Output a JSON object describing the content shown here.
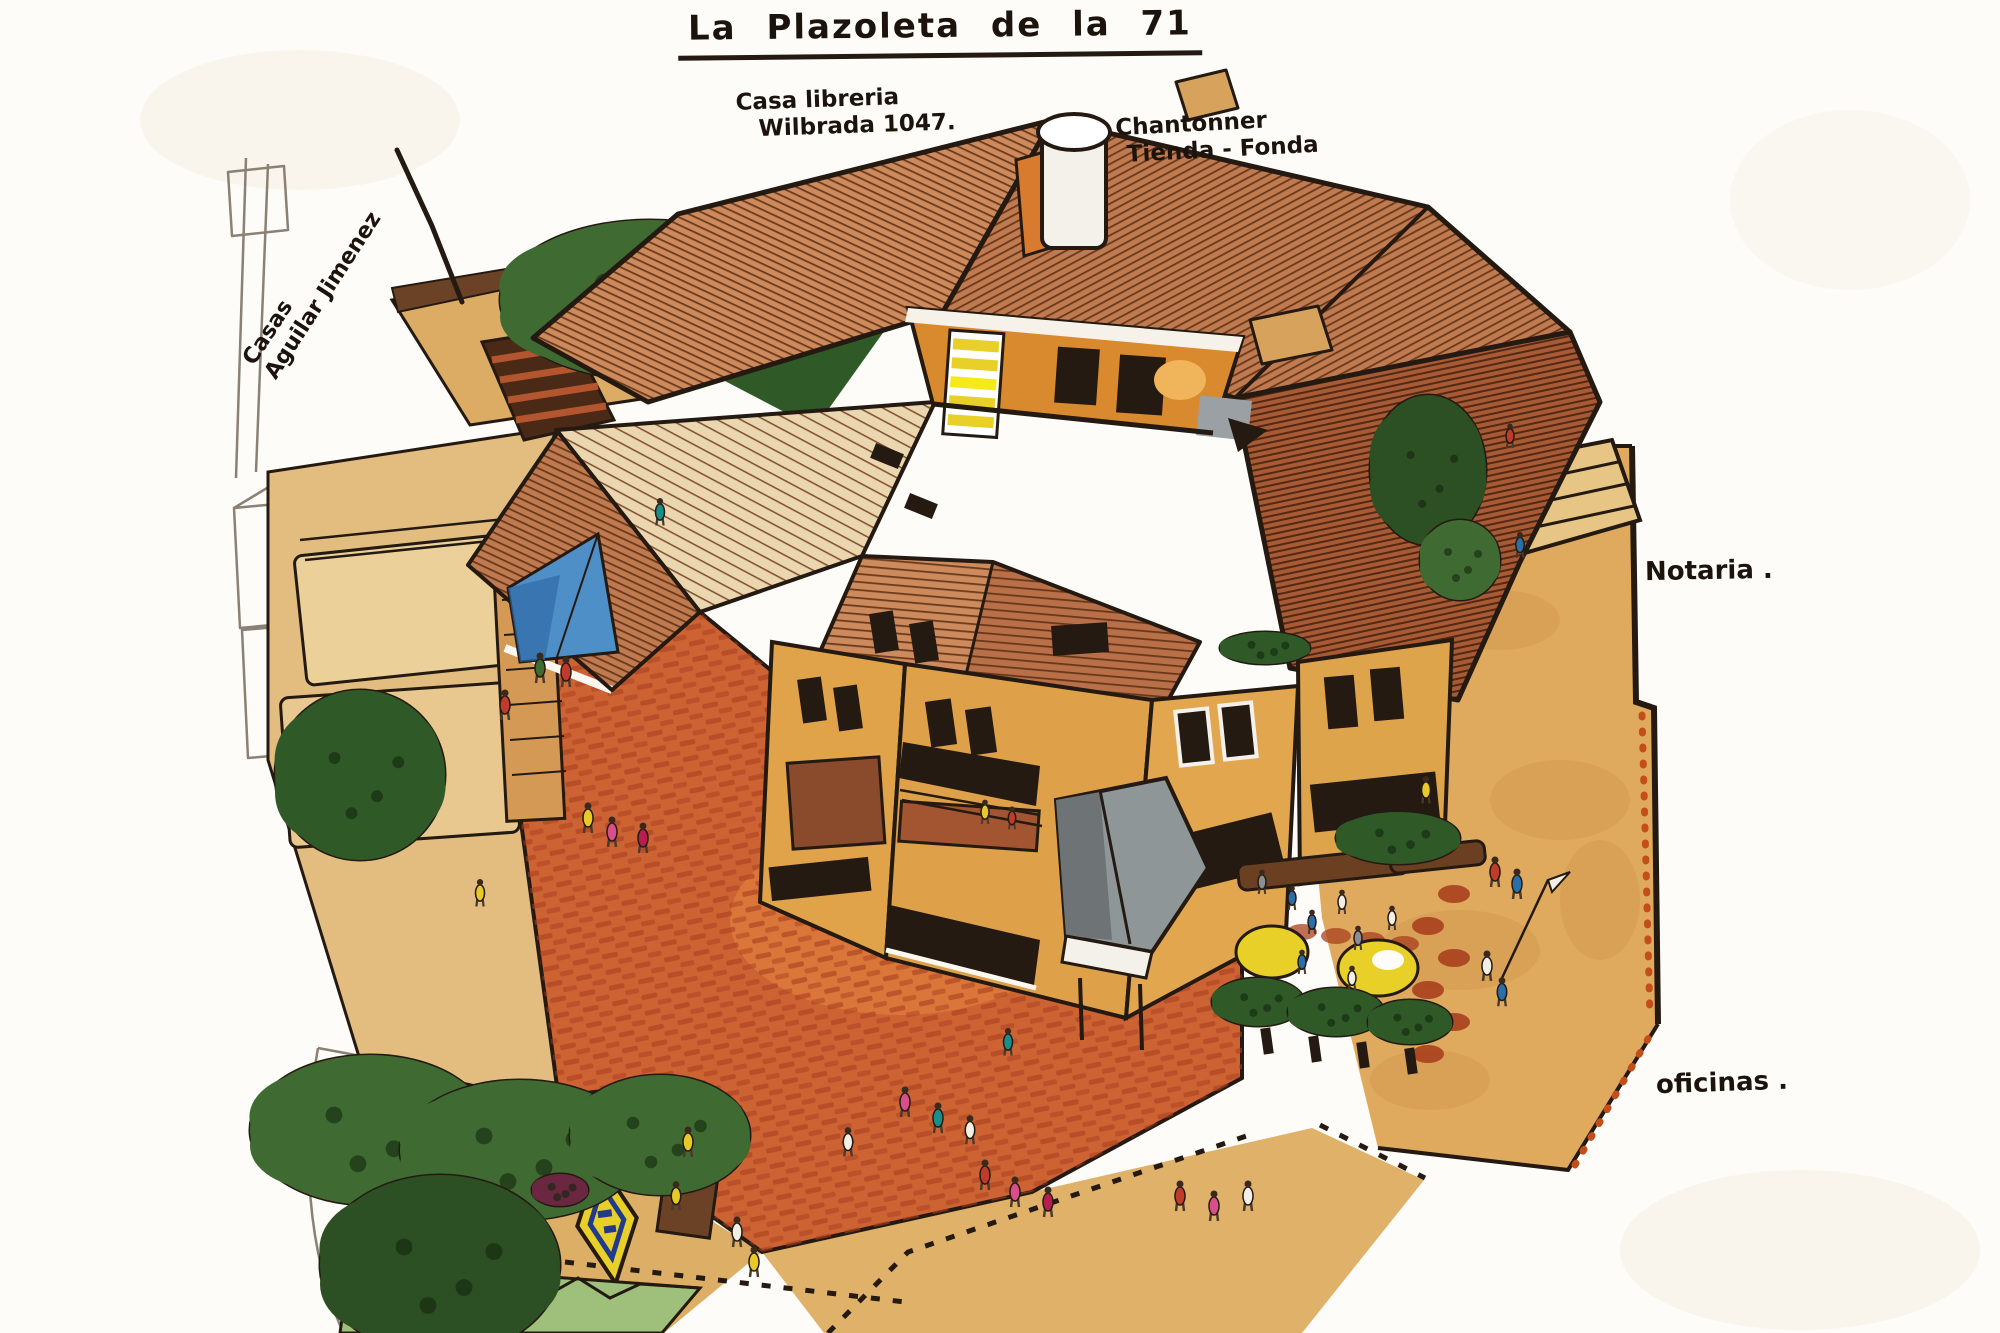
{
  "artwork": {
    "title": "La Plazoleta de la 71",
    "labels": {
      "bookstore": [
        "Casa libreria",
        "Wilbrada 1047."
      ],
      "shop": [
        "Chantonner",
        "Tienda - Fonda"
      ],
      "houses": [
        "Casas",
        "Aguilar Jimenez"
      ],
      "notary": "Notaria .",
      "offices": "oficinas ."
    },
    "palette": {
      "paper": "#fdfcf8",
      "ink": "#241a12",
      "pencil": "#8b8074",
      "roof_salmon": "#cd8a5c",
      "roof_terracotta": "#c07a50",
      "roof_dark": "#a85a34",
      "roof_cream": "#ead7b0",
      "wall_ochre": "#e0a34a",
      "courtyard_orange": "#d98a2e",
      "plaza_tan": "#dfaa5e",
      "stone_tan": "#e2bd7f",
      "brick_red": "#cd6233",
      "brick_dark": "#a8401f",
      "tree_green": "#3f6b33",
      "tree_dark_green": "#2c4f24",
      "tarp_blue": "#4e8fc7",
      "sign_yellow": "#e8d028",
      "people_pink": "#d94f8c",
      "people_red": "#c03b2a",
      "people_blue": "#2b6fa8"
    }
  }
}
